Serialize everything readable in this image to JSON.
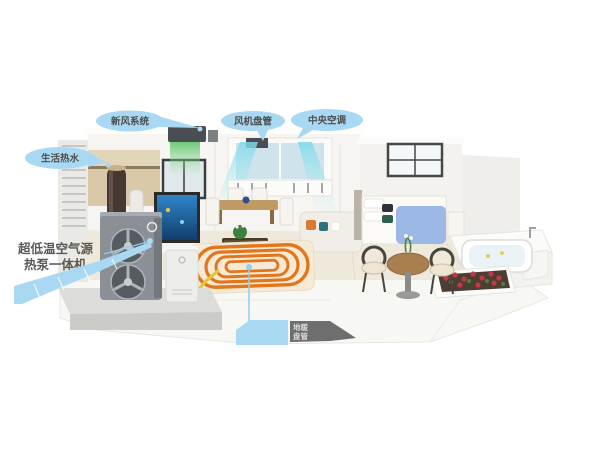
{
  "labels": {
    "fresh_air": "新风系统",
    "hot_water": "生活热水",
    "fan_coil": "风机盘管",
    "central_ac": "中央空调",
    "heat_pump": {
      "line1": "超低温空气源",
      "line2": "热泵一体机"
    },
    "floor_heating": {
      "line1": "地暖",
      "line2": "盘管"
    }
  },
  "colors": {
    "callout_fill": "#a9d9f2",
    "callout_text": "#4d4d4d",
    "dark_callout_text": "#595959",
    "pipe_yellow": "#e6c43c",
    "floor_coil_orange": "#e2761c",
    "airflow_cyan": "#7fd9ec",
    "vent_glow_green": "#5ec468",
    "heat_pump_body": "#8a9096",
    "bed_blue": "#9cb9e6",
    "flower_red": "#c23848"
  }
}
